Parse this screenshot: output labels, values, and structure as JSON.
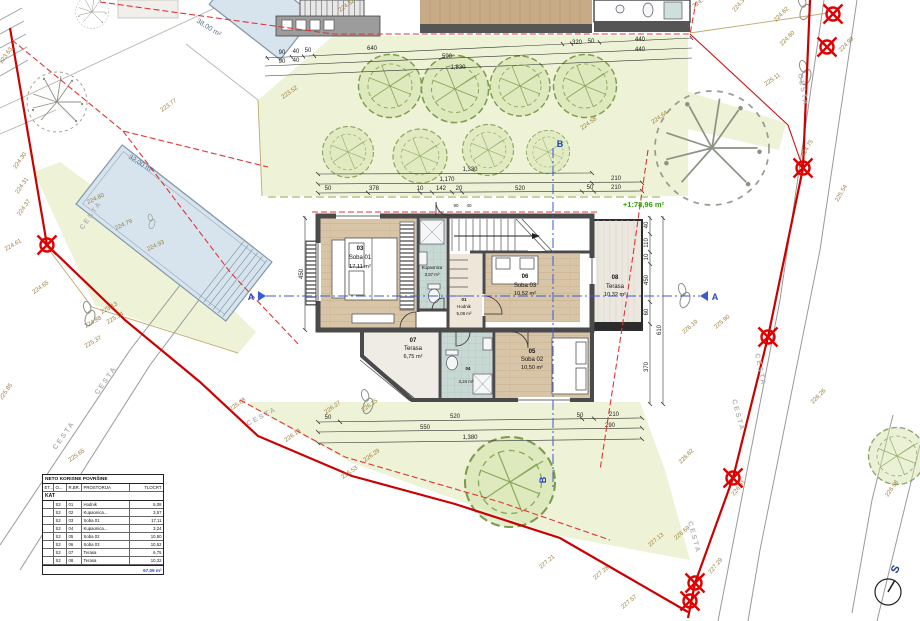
{
  "plan": {
    "areas": {
      "pool": "32,00 m²",
      "pool_top": "38,00 m²",
      "floor_total": "+1:78,96 m²"
    },
    "rooms": [
      {
        "num": "03",
        "name": "Soba 01",
        "area": "17,11 m²"
      },
      {
        "num": "02",
        "name": "Kupaonica",
        "area": "3,57 m²"
      },
      {
        "num": "01",
        "name": "Hodnik",
        "area": "5,08 m²"
      },
      {
        "num": "06",
        "name": "Soba 03",
        "area": "10,52 m²"
      },
      {
        "num": "08",
        "name": "Terasa",
        "area": "10,32 m²"
      },
      {
        "num": "07",
        "name": "Terasa",
        "area": "6,75 m²"
      },
      {
        "num": "04",
        "name": "Kupaonica",
        "area": "3,24 m²"
      },
      {
        "num": "05",
        "name": "Soba 02",
        "area": "10,50 m²"
      }
    ],
    "sections": {
      "a": "A",
      "b": "B"
    },
    "north_label": "S",
    "road_label": "CESTA",
    "dims": [
      "90",
      "40",
      "50",
      "640",
      "320",
      "50",
      "440",
      "90",
      "40",
      "590",
      "440",
      "1,830",
      "1,330",
      "1,170",
      "210",
      "50",
      "378",
      "10",
      "142",
      "20",
      "520",
      "50",
      "210",
      "50",
      "520",
      "50",
      "210",
      "550",
      "290",
      "1,380",
      "40",
      "110",
      "450",
      "60",
      "370",
      "610",
      "450",
      "90",
      "40",
      "10"
    ],
    "elevations": [
      "223.77",
      "223.52",
      "224.52",
      "224.44",
      "224.39",
      "224.62",
      "224.60",
      "224.99",
      "225.11",
      "224.64",
      "224.58",
      "224.75",
      "225.54",
      "224.80",
      "224.79",
      "224.93",
      "224.30",
      "224.31",
      "224.37",
      "224.61",
      "224.65",
      "225.13",
      "225.14",
      "224.88",
      "225.37",
      "225.65",
      "225.85",
      "226.13",
      "226.27",
      "226.15",
      "226.29",
      "226.53",
      "226.26",
      "226.62",
      "226.91",
      "227.29",
      "226.58",
      "227.13",
      "227.21",
      "227.28",
      "227.57",
      "226.69",
      "226.19",
      "225.90",
      "223.63",
      "225.68"
    ],
    "table": {
      "title": "NETO KORISNE POVRŠINE",
      "columns": [
        "ET...",
        "O...",
        "R.BR.",
        "PROSTORIJA",
        "TLOCRT"
      ],
      "section": "KAT",
      "rows": [
        [
          "S2",
          "01",
          "Hodnik",
          "5,08"
        ],
        [
          "S2",
          "02",
          "Kupaonica...",
          "3,57"
        ],
        [
          "S2",
          "03",
          "Soba 01",
          "17,11"
        ],
        [
          "S2",
          "04",
          "Kupaonica...",
          "3,24"
        ],
        [
          "S2",
          "05",
          "Soba 02",
          "10,50"
        ],
        [
          "S2",
          "06",
          "Soba 03",
          "10,52"
        ],
        [
          "S2",
          "07",
          "Terasa",
          "6,75"
        ],
        [
          "S2",
          "08",
          "Terasa",
          "10,32"
        ]
      ],
      "total": "67,09 m²"
    },
    "colors": {
      "boundary_red": "#cc0000",
      "section_blue": "#3a5bd0",
      "total_blue": "#2b47c4",
      "lawn_green": "#eef2d6",
      "elevation_olive": "#9b7d3c",
      "floor_total_green": "#2f9e00",
      "pool_blue": "#d7e4ee",
      "wood_floor": "#d8c4a6"
    }
  }
}
